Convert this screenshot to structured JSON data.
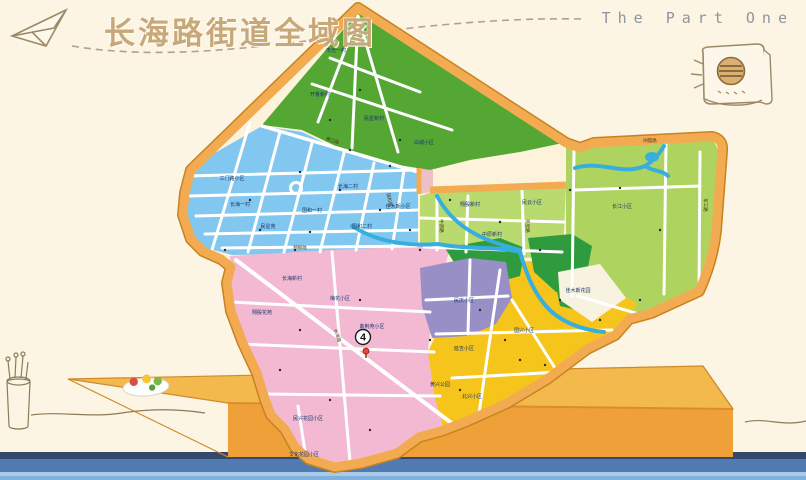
{
  "scene": {
    "wall_color": "#fcf5e3",
    "floor_colors": [
      "#33486b",
      "#4f7ab2",
      "#a9c9e6",
      "#7fb0de"
    ],
    "desk_top_color": "#f4b94d",
    "desk_front_color": "#efa038"
  },
  "header": {
    "title": "长海路街道全域图",
    "part_label": "The Part One"
  },
  "icons": {
    "paper_plane": "paper-plane-sketch",
    "notebook": "notebook-sketch",
    "pencil_cup": "pencil-cup-sketch"
  },
  "map": {
    "border_color": "#f3ab52",
    "marker": {
      "number": "4"
    },
    "region_colors": {
      "residential_blue": "#82c7ef",
      "green_north": "#55a733",
      "green_east": "#aed45f",
      "green_mid": "#b8da6e",
      "park_green": "#2e9c3e",
      "purple": "#998fc7",
      "yellow": "#f6c51c",
      "pink": "#f3b9d3",
      "pale_pink": "#edc0c5",
      "river": "#38aede"
    },
    "area_labels": [
      {
        "t": "市光一村",
        "x": 336,
        "y": 52
      },
      {
        "t": "开鲁新村",
        "x": 320,
        "y": 96
      },
      {
        "t": "民星新村",
        "x": 374,
        "y": 120
      },
      {
        "t": "白城小区",
        "x": 424,
        "y": 144
      },
      {
        "t": "三门路小区",
        "x": 232,
        "y": 180
      },
      {
        "t": "长海一村",
        "x": 240,
        "y": 206
      },
      {
        "t": "民星苑",
        "x": 268,
        "y": 228
      },
      {
        "t": "国和一村",
        "x": 312,
        "y": 212
      },
      {
        "t": "国和二村",
        "x": 362,
        "y": 228
      },
      {
        "t": "长海二村",
        "x": 348,
        "y": 188
      },
      {
        "t": "佳木斯小区",
        "x": 398,
        "y": 208
      },
      {
        "t": "翔殷新村",
        "x": 470,
        "y": 206
      },
      {
        "t": "民云小区",
        "x": 532,
        "y": 204
      },
      {
        "t": "中原新村",
        "x": 492,
        "y": 236
      },
      {
        "t": "长江小区",
        "x": 622,
        "y": 208
      },
      {
        "t": "梅花小区",
        "x": 340,
        "y": 300
      },
      {
        "t": "紫荆苑小区",
        "x": 372,
        "y": 328
      },
      {
        "t": "长海新村",
        "x": 292,
        "y": 280
      },
      {
        "t": "翔殷花苑",
        "x": 262,
        "y": 314
      },
      {
        "t": "民庆小区",
        "x": 464,
        "y": 302
      },
      {
        "t": "国兴小区",
        "x": 524,
        "y": 332
      },
      {
        "t": "延吉小区",
        "x": 464,
        "y": 350
      },
      {
        "t": "北兴小区",
        "x": 472,
        "y": 398
      },
      {
        "t": "黄兴公园",
        "x": 440,
        "y": 386
      },
      {
        "t": "佳木斯花园",
        "x": 578,
        "y": 292
      },
      {
        "t": "民兴花园小区",
        "x": 308,
        "y": 420
      },
      {
        "t": "文化花园小区",
        "x": 304,
        "y": 456
      }
    ],
    "road_labels": [
      {
        "t": "闸殷路",
        "x": 650,
        "y": 142,
        "r": 0
      },
      {
        "t": "军工路",
        "x": 704,
        "y": 205,
        "r": 90
      },
      {
        "t": "民星路",
        "x": 526,
        "y": 226,
        "r": 90
      },
      {
        "t": "中原路",
        "x": 440,
        "y": 226,
        "r": 90
      },
      {
        "t": "国和路",
        "x": 388,
        "y": 200,
        "r": 78
      },
      {
        "t": "嫩江路",
        "x": 332,
        "y": 142,
        "r": 18
      },
      {
        "t": "翔殷路",
        "x": 300,
        "y": 249,
        "r": 2
      },
      {
        "t": "长海路",
        "x": 336,
        "y": 336,
        "r": 70
      }
    ]
  }
}
